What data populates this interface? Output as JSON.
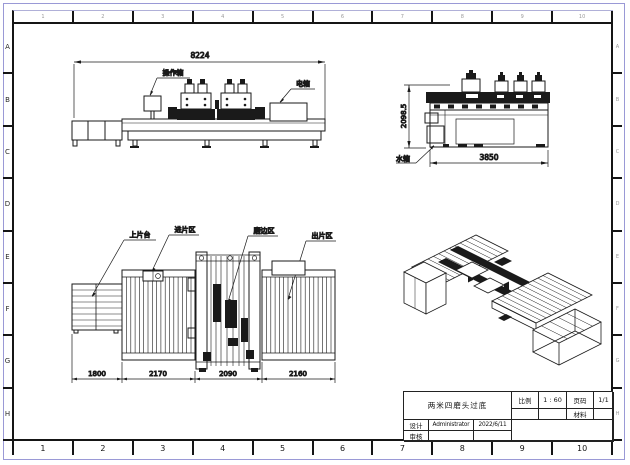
{
  "sheet": {
    "zone_columns": [
      "1",
      "2",
      "3",
      "4",
      "5",
      "6",
      "7",
      "8",
      "9",
      "10"
    ],
    "zone_rows": [
      "A",
      "B",
      "C",
      "D",
      "E",
      "F",
      "G",
      "H"
    ],
    "frame_color": "#151515",
    "outer_border_color": "#9a99d6",
    "line_color": "#1a1a1a"
  },
  "views": {
    "front": {
      "dim_width": "8224",
      "operation_box_label": "操作箱",
      "electric_box_label": "电箱"
    },
    "side": {
      "dim_height": "2098.5",
      "dim_width": "3850",
      "water_tank_label": "水箱"
    },
    "plan": {
      "loading_label": "上片台",
      "infeed_label": "进片区",
      "grinding_label": "磨边区",
      "outfeed_label": "出片区",
      "dim_1": "1800",
      "dim_2": "2170",
      "dim_3": "2090",
      "dim_4": "2160"
    }
  },
  "title_block": {
    "title": "两米四磨头过底",
    "scale_label": "比例",
    "scale_value": "1 : 60",
    "page_label": "页码",
    "page_value": "1/1",
    "material_label": "材料",
    "material_value": "",
    "design_label": "设计",
    "designer_value": "Administrator",
    "design_date": "2022/6/11",
    "review_label": "审核",
    "reviewer_value": ""
  }
}
